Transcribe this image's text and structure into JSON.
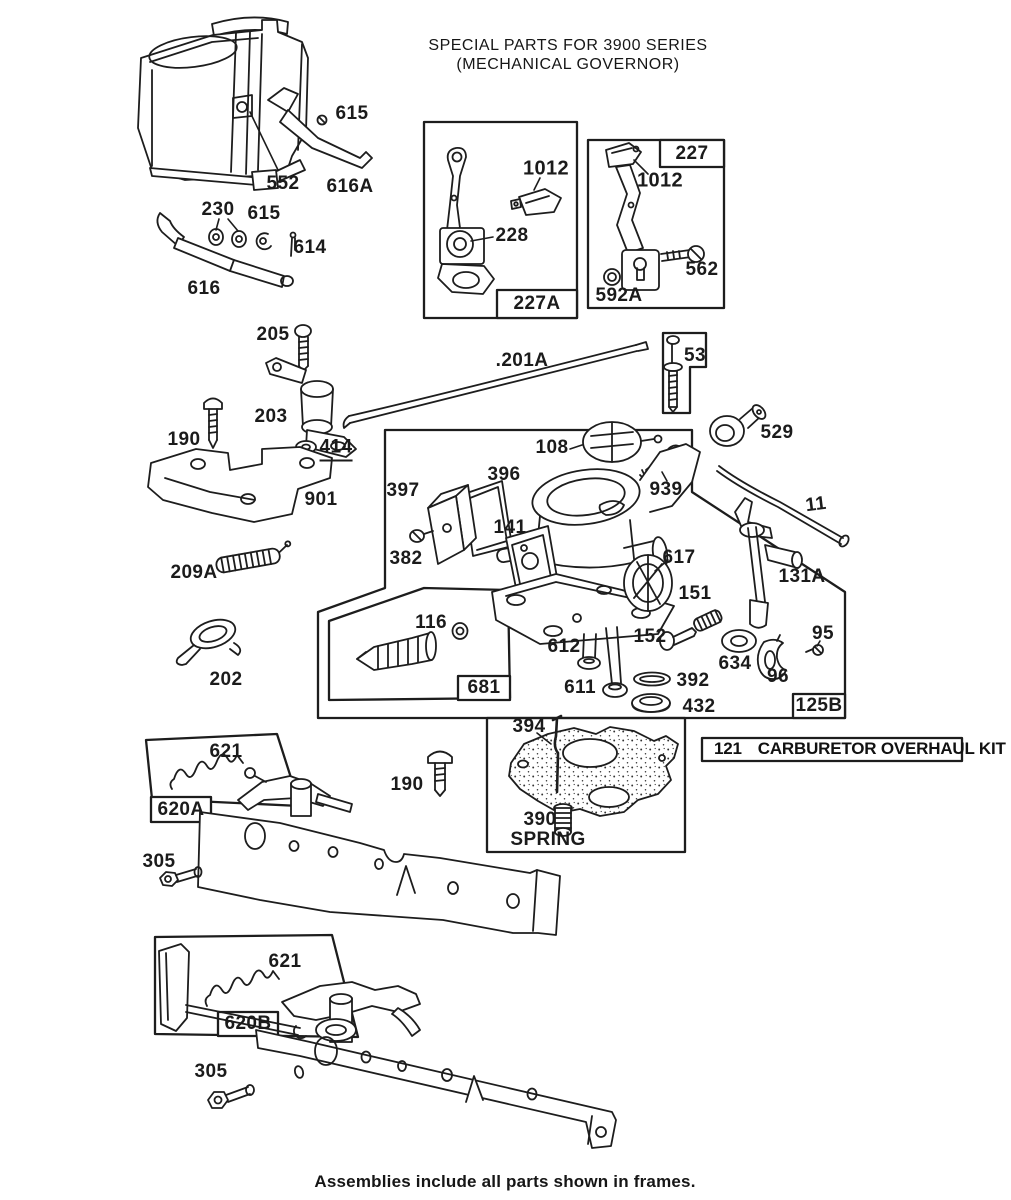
{
  "page": {
    "title_line1": "SPECIAL PARTS FOR 3900 SERIES",
    "title_line2": "(MECHANICAL GOVERNOR)",
    "footer": "Assemblies include all parts shown in frames."
  },
  "frames": {
    "tag_227a": "227A",
    "tag_227": "227",
    "tag_53": "53",
    "tag_681": "681",
    "tag_125b": "125B",
    "tag_620a": "620A",
    "tag_620b": "620B"
  },
  "kit": {
    "number": "121",
    "name": "CARBURETOR OVERHAUL KIT"
  },
  "parts": {
    "p615_top": "615",
    "p552": "552",
    "p616a": "616A",
    "p230": "230",
    "p615_mid": "615",
    "p614": "614",
    "p616": "616",
    "p1012_a": "1012",
    "p228": "228",
    "p1012_b": "1012",
    "p562": "562",
    "p592a": "592A",
    "p529": "529",
    "p201a": ".201A",
    "p205": "205",
    "p203": "203",
    "p190_left": "190",
    "p414": "414",
    "p901": "901",
    "p108": "108",
    "p939": "939",
    "p11": "11",
    "p209a": "209A",
    "p397": "397",
    "p396": "396",
    "p382": "382",
    "p141": "141",
    "p617": "617",
    "p131a": "131A",
    "p151": "151",
    "p202": "202",
    "p116": "116",
    "p152": "152",
    "p634": "634",
    "p95": "95",
    "p96": "96",
    "p612": "612",
    "p611": "611",
    "p392": "392",
    "p432": "432",
    "p394": "394",
    "p390": "390",
    "spring_caption": "SPRING",
    "p621_top": "621",
    "p190_right": "190",
    "p305_top": "305",
    "p621_bottom": "621",
    "p305_bottom": "305"
  }
}
